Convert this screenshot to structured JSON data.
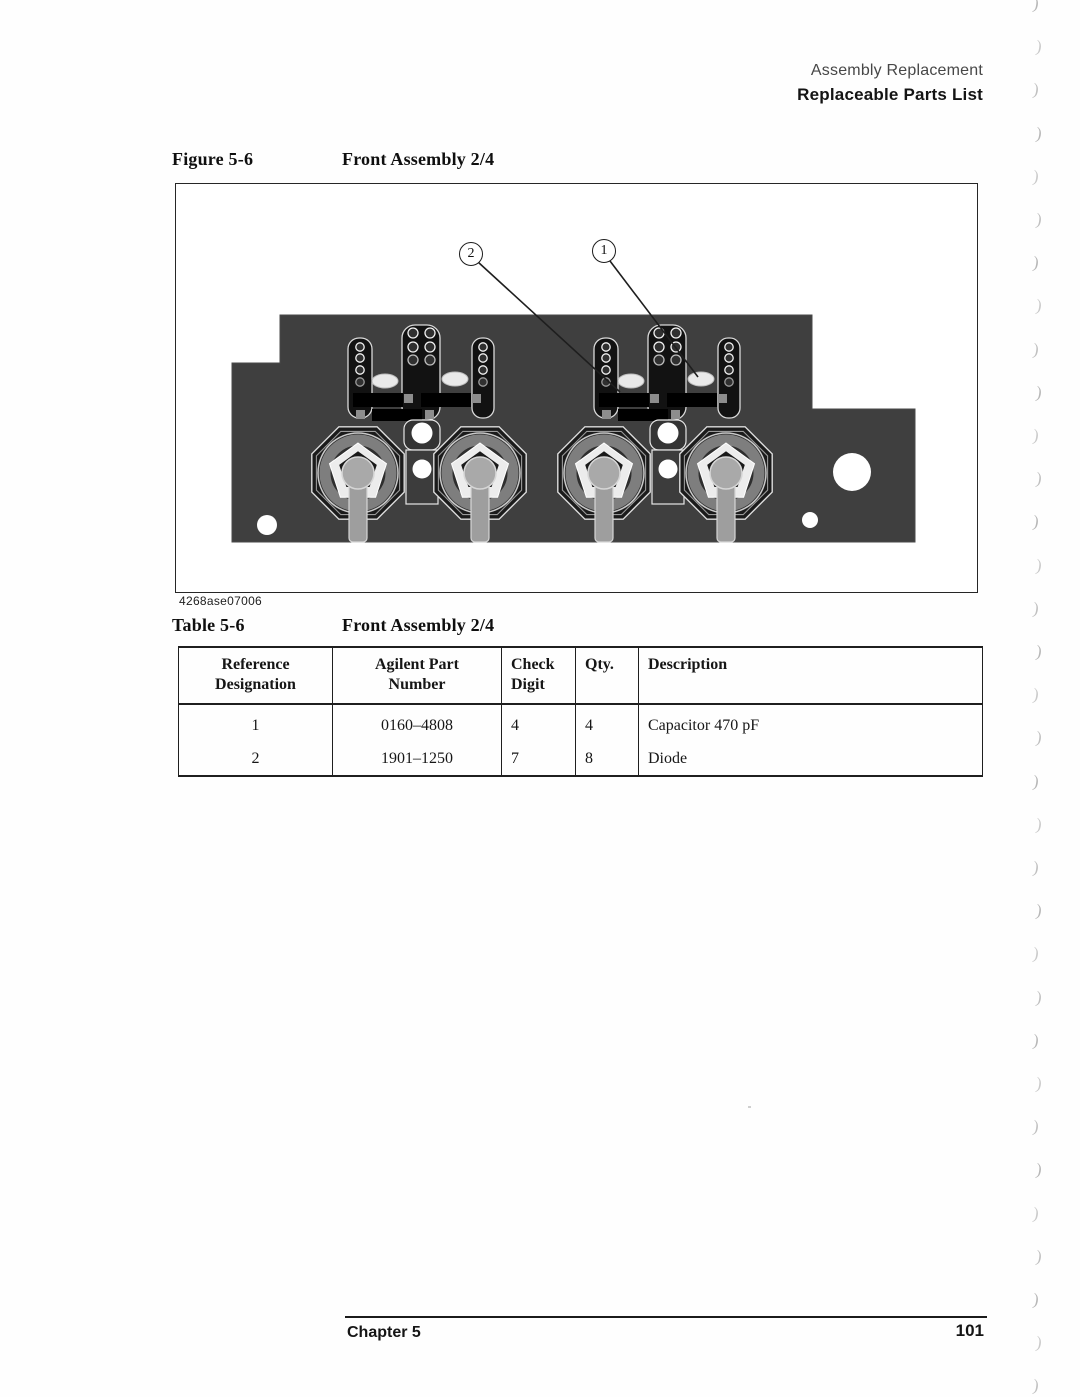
{
  "page_header": {
    "section": "Assembly Replacement",
    "subsection": "Replaceable Parts List"
  },
  "figure": {
    "label": "Figure 5-6",
    "title": "Front Assembly 2/4",
    "image_code": "4268ase07006",
    "callouts": [
      {
        "label": "2"
      },
      {
        "label": "1"
      }
    ]
  },
  "table": {
    "label": "Table 5-6",
    "title": "Front Assembly 2/4",
    "columns": [
      "Reference\nDesignation",
      "Agilent Part\nNumber",
      "Check\nDigit",
      "Qty.",
      "Description"
    ],
    "rows": [
      [
        "1",
        "0160–4808",
        "4",
        "4",
        "Capacitor 470 pF"
      ],
      [
        "2",
        "1901–1250",
        "7",
        "8",
        "Diode"
      ]
    ]
  },
  "footer": {
    "chapter": "Chapter 5",
    "page_number": "101"
  },
  "artifacts": {
    "margin_mark_glyph": ")",
    "margin_mark_count": 33
  }
}
